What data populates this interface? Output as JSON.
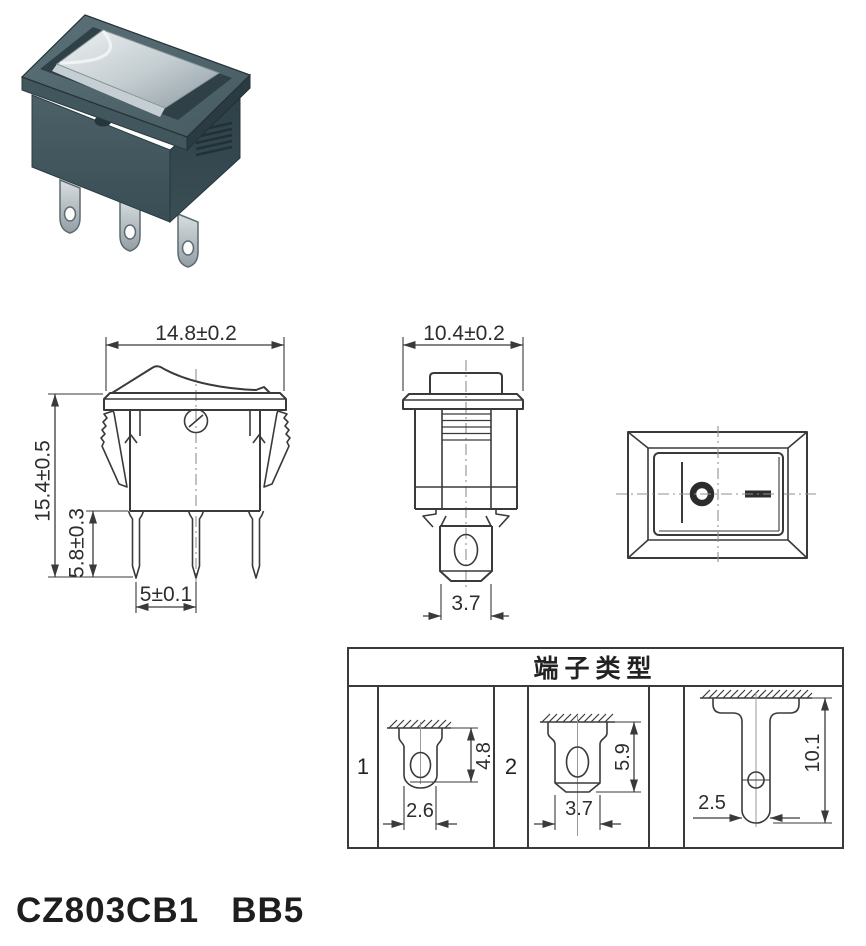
{
  "model_label": "CZ803CB1   BB5",
  "views": {
    "front": {
      "width_dim": "14.8±0.2",
      "height_dim": "15.4±0.5",
      "pin_length_dim": "5.8±0.3",
      "pin_pitch_dim": "5±0.1"
    },
    "side": {
      "width_dim": "10.4±0.2",
      "terminal_width_dim": "3.7"
    }
  },
  "terminal_table": {
    "title": "端子类型",
    "types": [
      {
        "label": "1",
        "width_dim": "2.6",
        "length_dim": "4.8"
      },
      {
        "label": "2",
        "width_dim": "3.7",
        "length_dim": "5.9"
      },
      {
        "label": "",
        "width_dim": "2.5",
        "length_dim": "10.1"
      }
    ]
  }
}
